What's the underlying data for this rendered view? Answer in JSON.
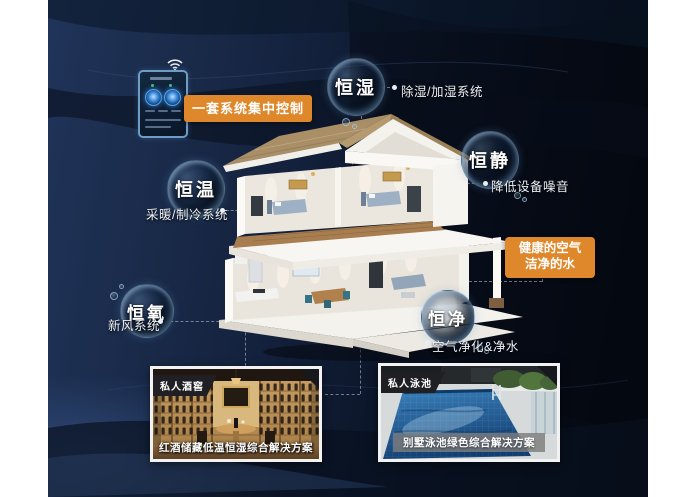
{
  "colors": {
    "accent": "#df872b",
    "canvas_dark": "#0b1426",
    "bubble_rim": "#96c3e6",
    "pool_water": "#2f74b0",
    "wine_wood": "#c49a5e"
  },
  "control_panel": {
    "label": "一套系统集中控制"
  },
  "features": {
    "humidity": {
      "name": "恒湿",
      "desc": "除湿/加湿系统"
    },
    "quiet": {
      "name": "恒静",
      "desc": "降低设备噪音"
    },
    "temperature": {
      "name": "恒温",
      "desc": "采暖/制冷系统"
    },
    "oxygen": {
      "name": "恒氧",
      "desc": "新风系统"
    },
    "purity": {
      "name": "恒净",
      "desc": "空气净化&净水"
    }
  },
  "highlight_box": {
    "line1": "健康的空气",
    "line2": "洁净的水"
  },
  "cards": {
    "wine": {
      "tag": "私人酒窖",
      "caption": "红酒储藏低温恒湿综合解决方案"
    },
    "pool": {
      "tag": "私人泳池",
      "caption": "别墅泳池绿色综合解决方案"
    }
  }
}
